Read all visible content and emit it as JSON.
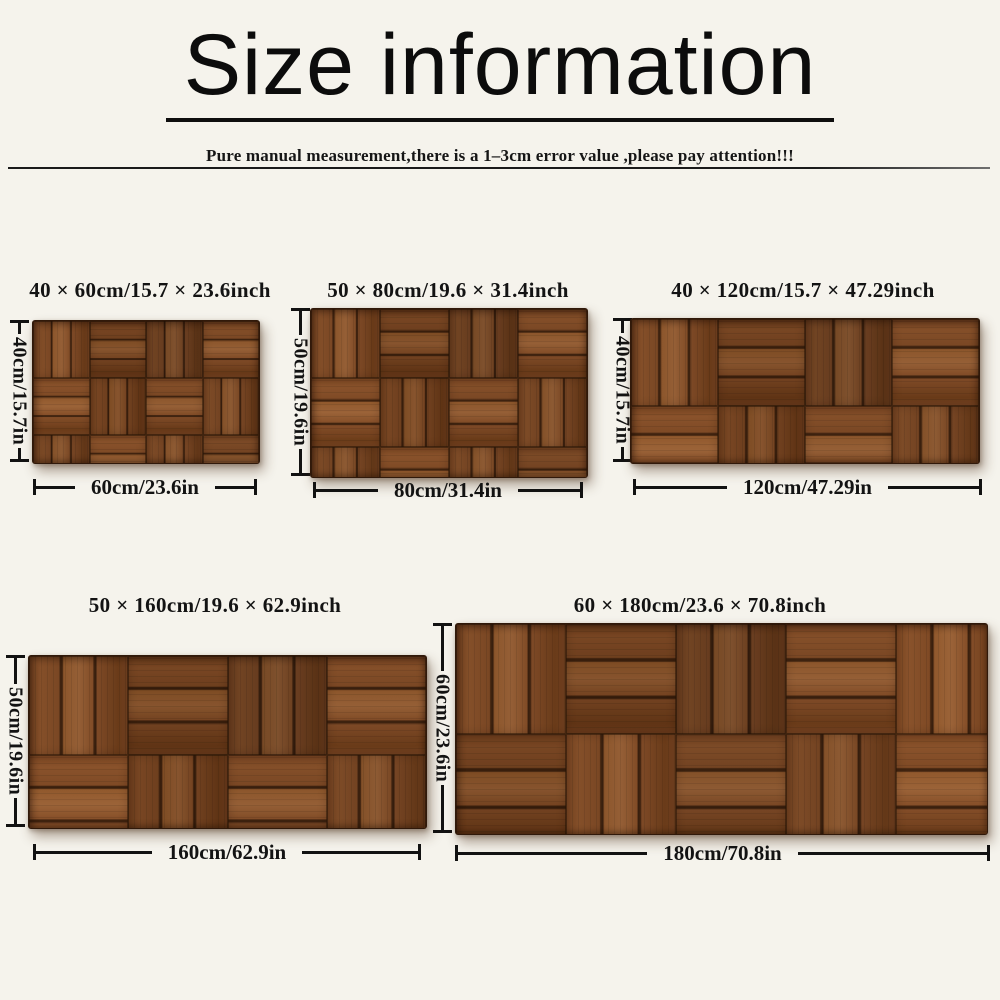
{
  "header": {
    "title": "Size information",
    "subtitle": "Pure manual measurement,there is a 1–3cm error value ,please pay attention!!!"
  },
  "figures": [
    {
      "size_label": "40 × 60cm/15.7 × 23.6inch",
      "height_label": "40cm/15.7in",
      "width_label": "60cm/23.6in"
    },
    {
      "size_label": "50 × 80cm/19.6 × 31.4inch",
      "height_label": "50cm/19.6in",
      "width_label": "80cm/31.4in"
    },
    {
      "size_label": "40 × 120cm/15.7 × 47.29inch",
      "height_label": "40cm/15.7in",
      "width_label": "120cm/47.29in"
    },
    {
      "size_label": "50 × 160cm/19.6 × 62.9inch",
      "height_label": "50cm/19.6in",
      "width_label": "160cm/62.9in"
    },
    {
      "size_label": "60 × 180cm/23.6 × 70.8inch",
      "height_label": "60cm/23.6in",
      "width_label": "180cm/70.8in"
    }
  ],
  "colors": {
    "background": "#f5f3ec",
    "text": "#131313",
    "wood_base": "#7a4825",
    "wood_light": "#8d5a33",
    "wood_dark": "#643818",
    "plank_gap": "#3a200e"
  }
}
